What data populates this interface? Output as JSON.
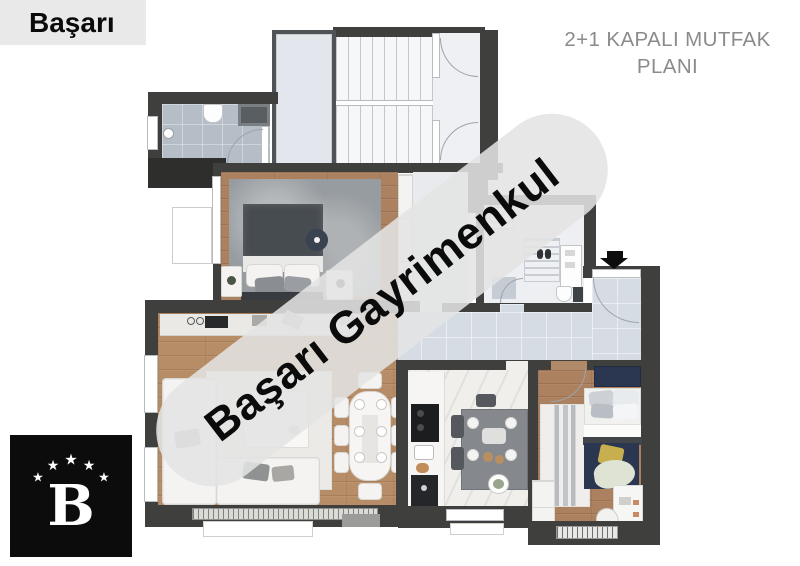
{
  "brand": {
    "label": "Başarı",
    "watermark_text": "Başarı Gayrimenkul",
    "logo_letter": "B",
    "logo_stars": [
      "★",
      "★",
      "★",
      "★",
      "★"
    ]
  },
  "title": {
    "line1": "2+1 KAPALI MUTFAK",
    "line2": "PLANI"
  },
  "icons": {
    "entrance_arrow": "solid-black-down-arrow",
    "logo_star": "★"
  },
  "colors": {
    "wall": "#3f3f3d",
    "wall_dark": "#2e2e2c",
    "label_bg": "#e9e9e9",
    "title_text": "#8b8b8b",
    "watermark_band": "#e3e3e3",
    "watermark_text": "#0b0b0b",
    "logo_bg": "#0c0c0c",
    "wood_floor": "#ab8160",
    "wood_floor_light": "#b68d66",
    "bath_tile": "#b5bdc7",
    "hall_tile": "#d6dce3",
    "kitchen_floor": "#f0efec",
    "navy": "#2b3750",
    "accent_yellow": "#c7ae4e"
  }
}
